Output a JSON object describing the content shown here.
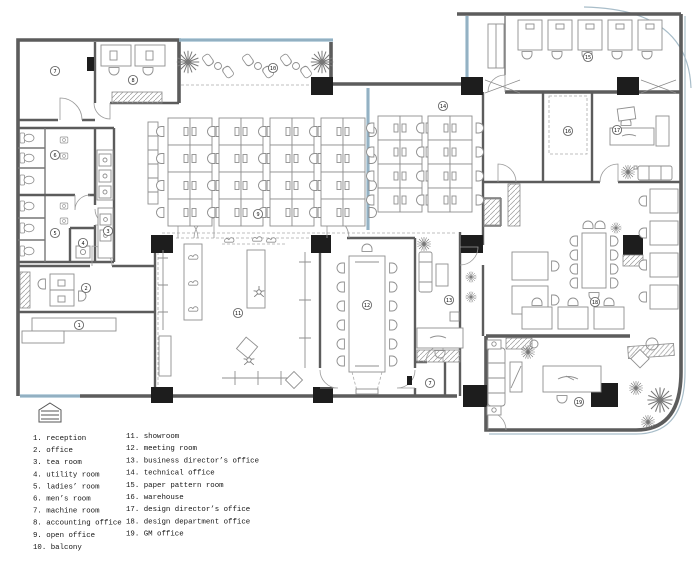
{
  "legend": {
    "column1": [
      "1. reception",
      "2. office",
      "3. tea room",
      "4. utility room",
      "5. ladies’ room",
      "6. men’s room",
      "7. machine room",
      "8. accounting office",
      "9. open office",
      "10. balcony"
    ],
    "column2": [
      "11. showroom",
      "12. meeting room",
      "13. business director’s office",
      "14. technical office",
      "15. paper pattern room",
      "16. warehouse",
      "17. design director’s office",
      "18. design department office",
      "19. GM office"
    ]
  },
  "room_markers": [
    {
      "n": "1",
      "x": 79,
      "y": 325
    },
    {
      "n": "2",
      "x": 86,
      "y": 288
    },
    {
      "n": "3",
      "x": 108,
      "y": 231
    },
    {
      "n": "4",
      "x": 83,
      "y": 243
    },
    {
      "n": "5",
      "x": 55,
      "y": 233
    },
    {
      "n": "6",
      "x": 55,
      "y": 155
    },
    {
      "n": "7",
      "x": 55,
      "y": 71
    },
    {
      "n": "7",
      "x": 430,
      "y": 383
    },
    {
      "n": "8",
      "x": 133,
      "y": 80
    },
    {
      "n": "9",
      "x": 258,
      "y": 214
    },
    {
      "n": "10",
      "x": 273,
      "y": 68
    },
    {
      "n": "11",
      "x": 238,
      "y": 313
    },
    {
      "n": "12",
      "x": 367,
      "y": 305
    },
    {
      "n": "13",
      "x": 449,
      "y": 300
    },
    {
      "n": "14",
      "x": 443,
      "y": 106
    },
    {
      "n": "15",
      "x": 588,
      "y": 57
    },
    {
      "n": "16",
      "x": 568,
      "y": 131
    },
    {
      "n": "17",
      "x": 617,
      "y": 130
    },
    {
      "n": "18",
      "x": 595,
      "y": 302
    },
    {
      "n": "19",
      "x": 579,
      "y": 402
    }
  ],
  "colors": {
    "wall": "#5c5c5c",
    "column": "#1d1d1d",
    "glazing": "#a7c3d3",
    "glazing_dark": "#7d9cb0",
    "furniture": "#8f8f8f",
    "text": "#141414"
  }
}
